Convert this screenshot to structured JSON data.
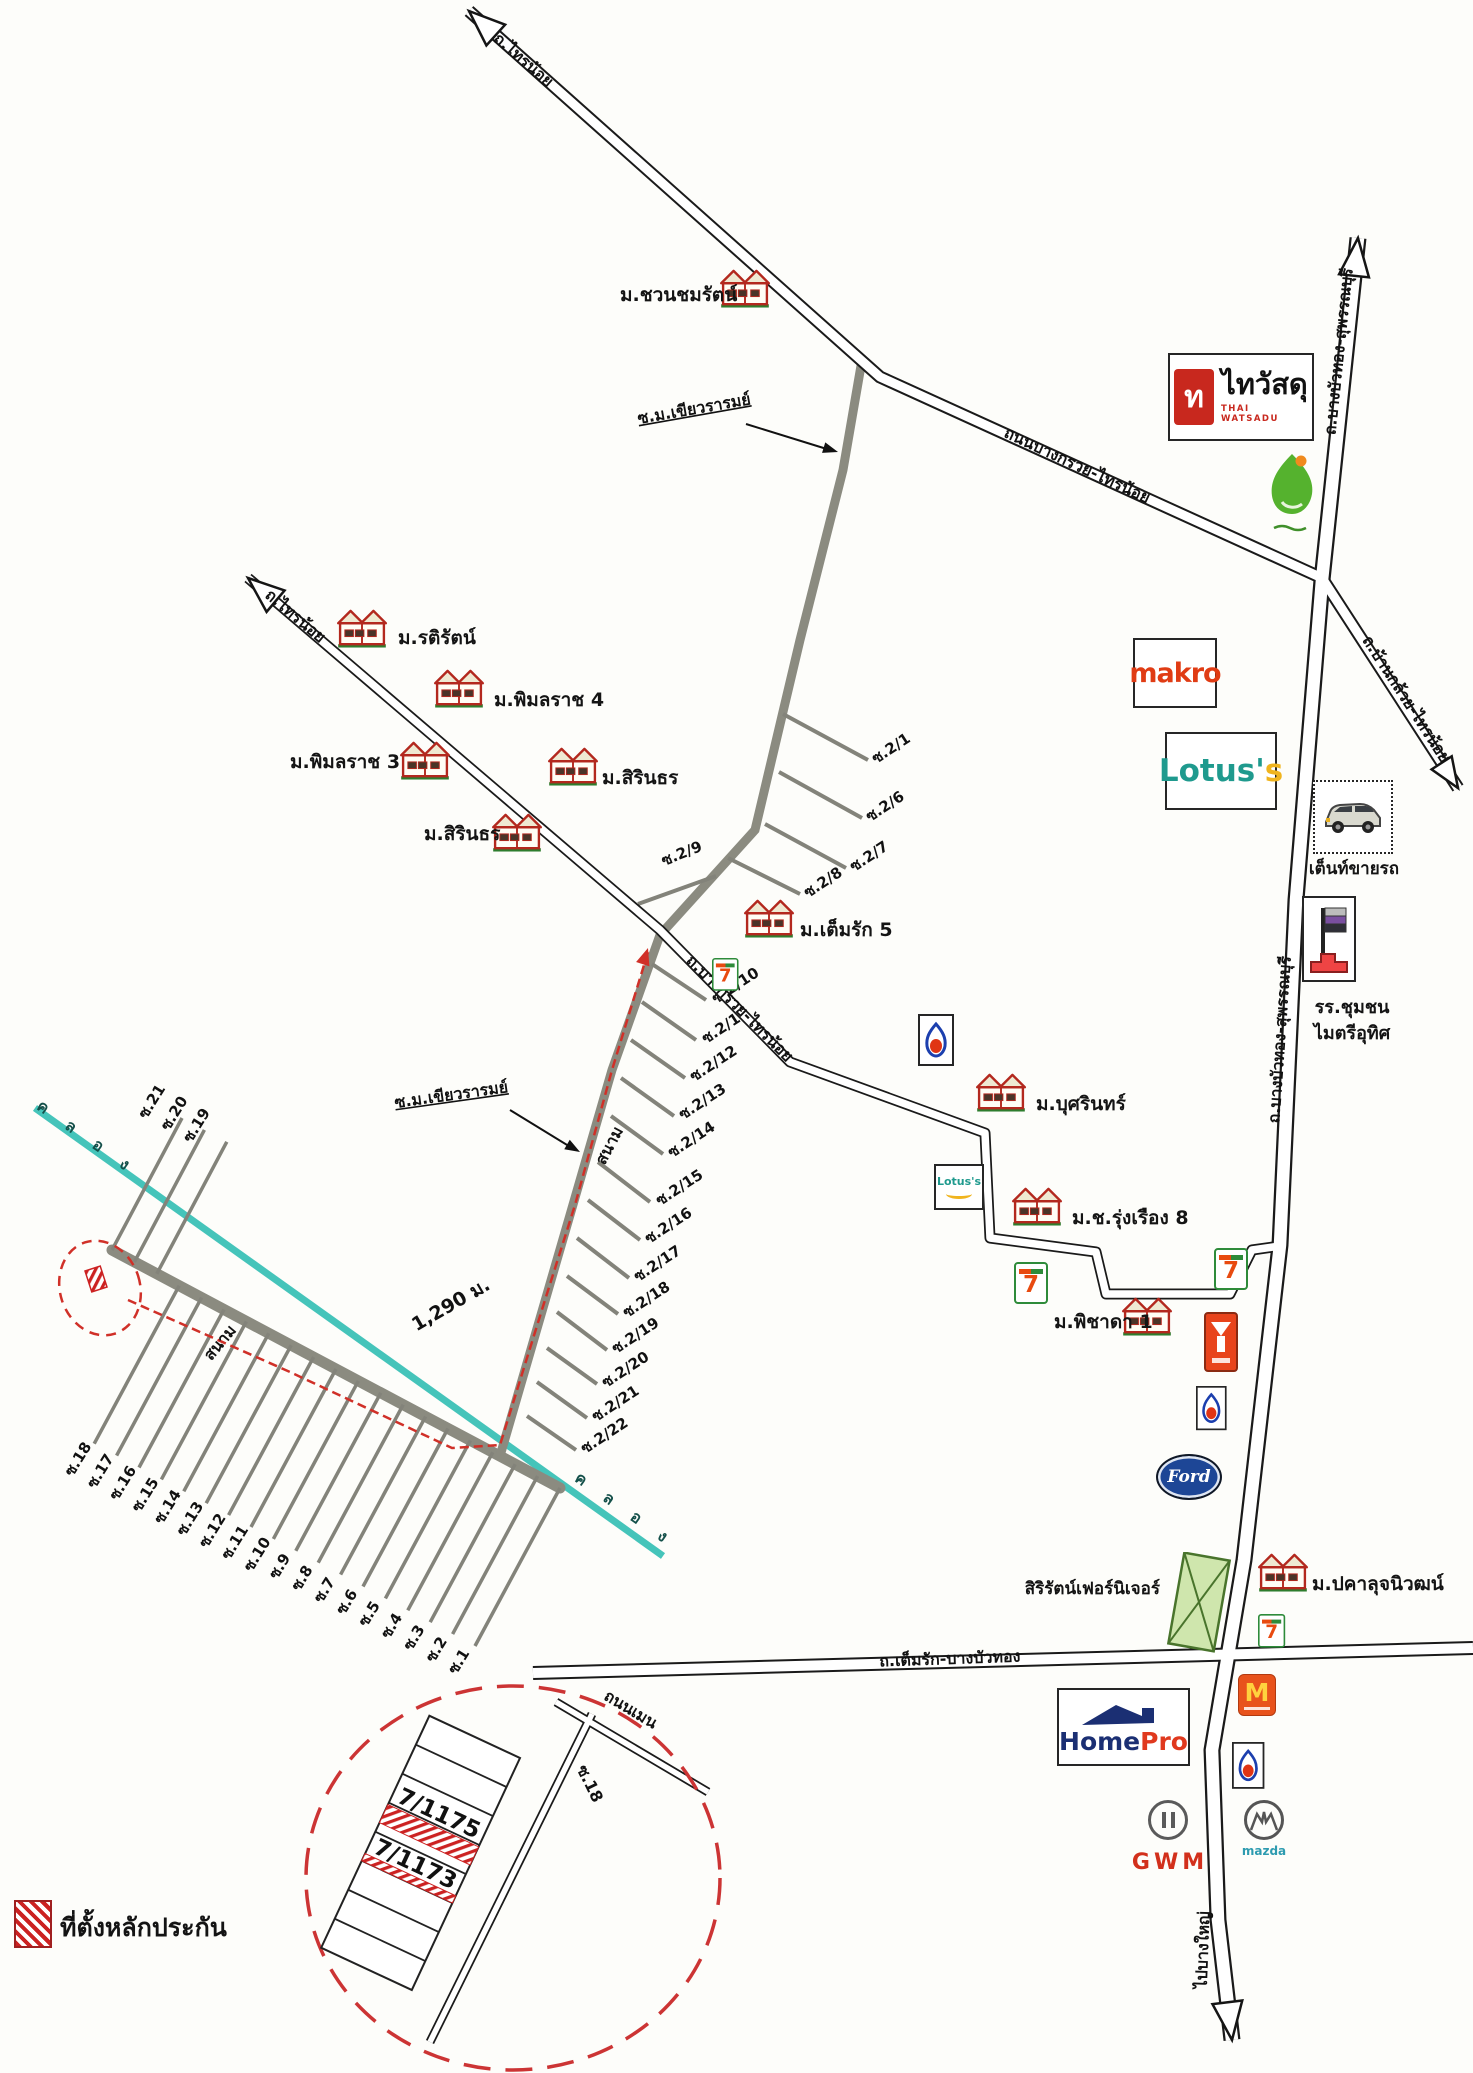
{
  "map": {
    "legend_label": "ที่ตั้งหลักประกัน",
    "distance_label": "1,290 ม.",
    "canal_label": "ค ล อ ง",
    "field_label_1": "สนาม",
    "field_label_2": "สนาม"
  },
  "roads": {
    "r1_end": "ถ.ไทรน้อย",
    "r2_end": "ถ.ไทรน้อย",
    "r1_mid": "ถนนบางกรวย-ไทรน้อย",
    "r1_se": "ถ.บ้านกล้วย-ไทรน้อย",
    "r2_name": "ถ.บางกรวย-ไทรน้อย",
    "v1_top": "ถ.บางบัวทอง-สุพรรณบุรี",
    "v1_mid": "ถ.บางบัวทอง-สุพรรณบุรี",
    "v1_bottom": "ไปบางใหญ่",
    "h1_name": "ถ.เต็มรัก-บางบัวทอง",
    "soi_khiao_1": "ซ.ม.เขียวรารมย์",
    "soi_khiao_2": "ซ.ม.เขียวรารมย์",
    "inset_main": "ถนนเมน",
    "inset_soi": "ซ.18"
  },
  "villages": [
    "ม.ชวนชมรัตน์",
    "ม.รติรัตน์",
    "ม.พิมลราช 4",
    "ม.พิมลราช 3",
    "ม.สิรินธร",
    "ม.สิรินธร",
    "ม.เต็มรัก 5",
    "ม.บุศรินทร์",
    "ม.ช.รุ่งเรือง 8",
    "ม.พิชาดา 1",
    "ม.ปคาลุจนิวฒน์"
  ],
  "sois_upper": [
    "ซ.2/1",
    "ซ.2/6",
    "ซ.2/7",
    "ซ.2/8",
    "ซ.2/9",
    "ซ.2/10",
    "ซ.2/11",
    "ซ.2/12",
    "ซ.2/13",
    "ซ.2/14",
    "ซ.2/15",
    "ซ.2/16",
    "ซ.2/17",
    "ซ.2/18",
    "ซ.2/19",
    "ซ.2/20",
    "ซ.2/21",
    "ซ.2/22"
  ],
  "sois_lower": [
    "ซ.21",
    "ซ.20",
    "ซ.19",
    "ซ.18",
    "ซ.17",
    "ซ.16",
    "ซ.15",
    "ซ.14",
    "ซ.13",
    "ซ.12",
    "ซ.11",
    "ซ.10",
    "ซ.9",
    "ซ.8",
    "ซ.7",
    "ซ.6",
    "ซ.5",
    "ซ.4",
    "ซ.3",
    "ซ.2",
    "ซ.1"
  ],
  "plots": {
    "plot_a": "7/1175",
    "plot_b": "7/1173"
  },
  "brands": {
    "thaiwatsadu_icon": "ท",
    "thaiwatsadu_thai": "ไทวัสดุ",
    "thaiwatsadu_en": "THAI WATSADU",
    "makro": "makro",
    "lotus_main": "Lotus'",
    "lotus_accent": "s",
    "lotus_mini": "Lotus's",
    "car_tent": "เต็นท์ขายรถ",
    "school_line1": "รร.ชุมชน",
    "school_line2": "ไมตรีอุทิศ",
    "seven": "7",
    "homepro_home": "Home",
    "homepro_pro": "Pro",
    "mcdonalds": "M",
    "gwm": "GWM",
    "mazda": "mazda",
    "ford": "Ford",
    "furniture": "สิริรัตน์เฟอร์นิเจอร์"
  },
  "colors": {
    "canal": "#45c4ba",
    "route_red": "#d03028",
    "hatch_red": "#cc2222",
    "road_gray": "#8b8b80",
    "makro_red": "#e03c14",
    "lotus_teal": "#1f9a8e",
    "lotus_yellow": "#f0b41e",
    "homepro_navy": "#1b2f73",
    "homepro_red": "#e0391e",
    "thaiwatsadu_red": "#c8281e"
  }
}
